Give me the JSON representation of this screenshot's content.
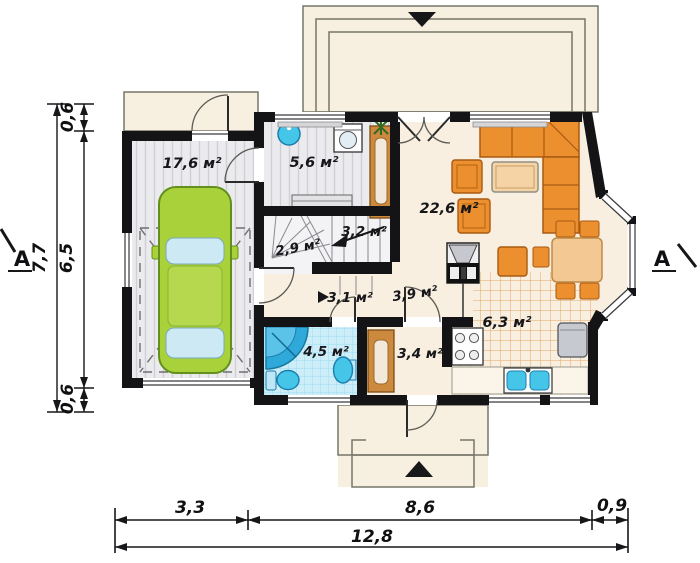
{
  "plan": {
    "title": "ground-floor-plan",
    "rooms": {
      "garage": "17,6 м²",
      "utility": "5,6 м²",
      "stair_hall": "2,9 м²",
      "stairs": "3,2 м²",
      "living": "22,6 м²",
      "hall": "3,1 м²",
      "corridor": "3,9 м²",
      "bathroom": "4,5 м²",
      "dressing": "3,4 м²",
      "kitchen": "6,3 м²"
    },
    "dimensions": {
      "left": {
        "top": "0,6",
        "middle": "6,5",
        "bottom": "0,6",
        "total": "7,7"
      },
      "bottom": {
        "left": "3,3",
        "middle": "8,6",
        "right": "0,9",
        "total": "12,8"
      }
    },
    "section": {
      "left": "A",
      "right": "A"
    },
    "colors": {
      "wall": "#141416",
      "floor_cream": "#f8efe0",
      "garage_floor": "#ebebee",
      "bath_tile": "#cdeef9",
      "kitchen_grid": "#e4a766",
      "furniture_orange": "#ec8f2f",
      "table_tan": "#f3c892",
      "car_green": "#a9d13a",
      "fixture_blue": "#45c6e8",
      "shower_blue": "#2fa8da"
    }
  }
}
